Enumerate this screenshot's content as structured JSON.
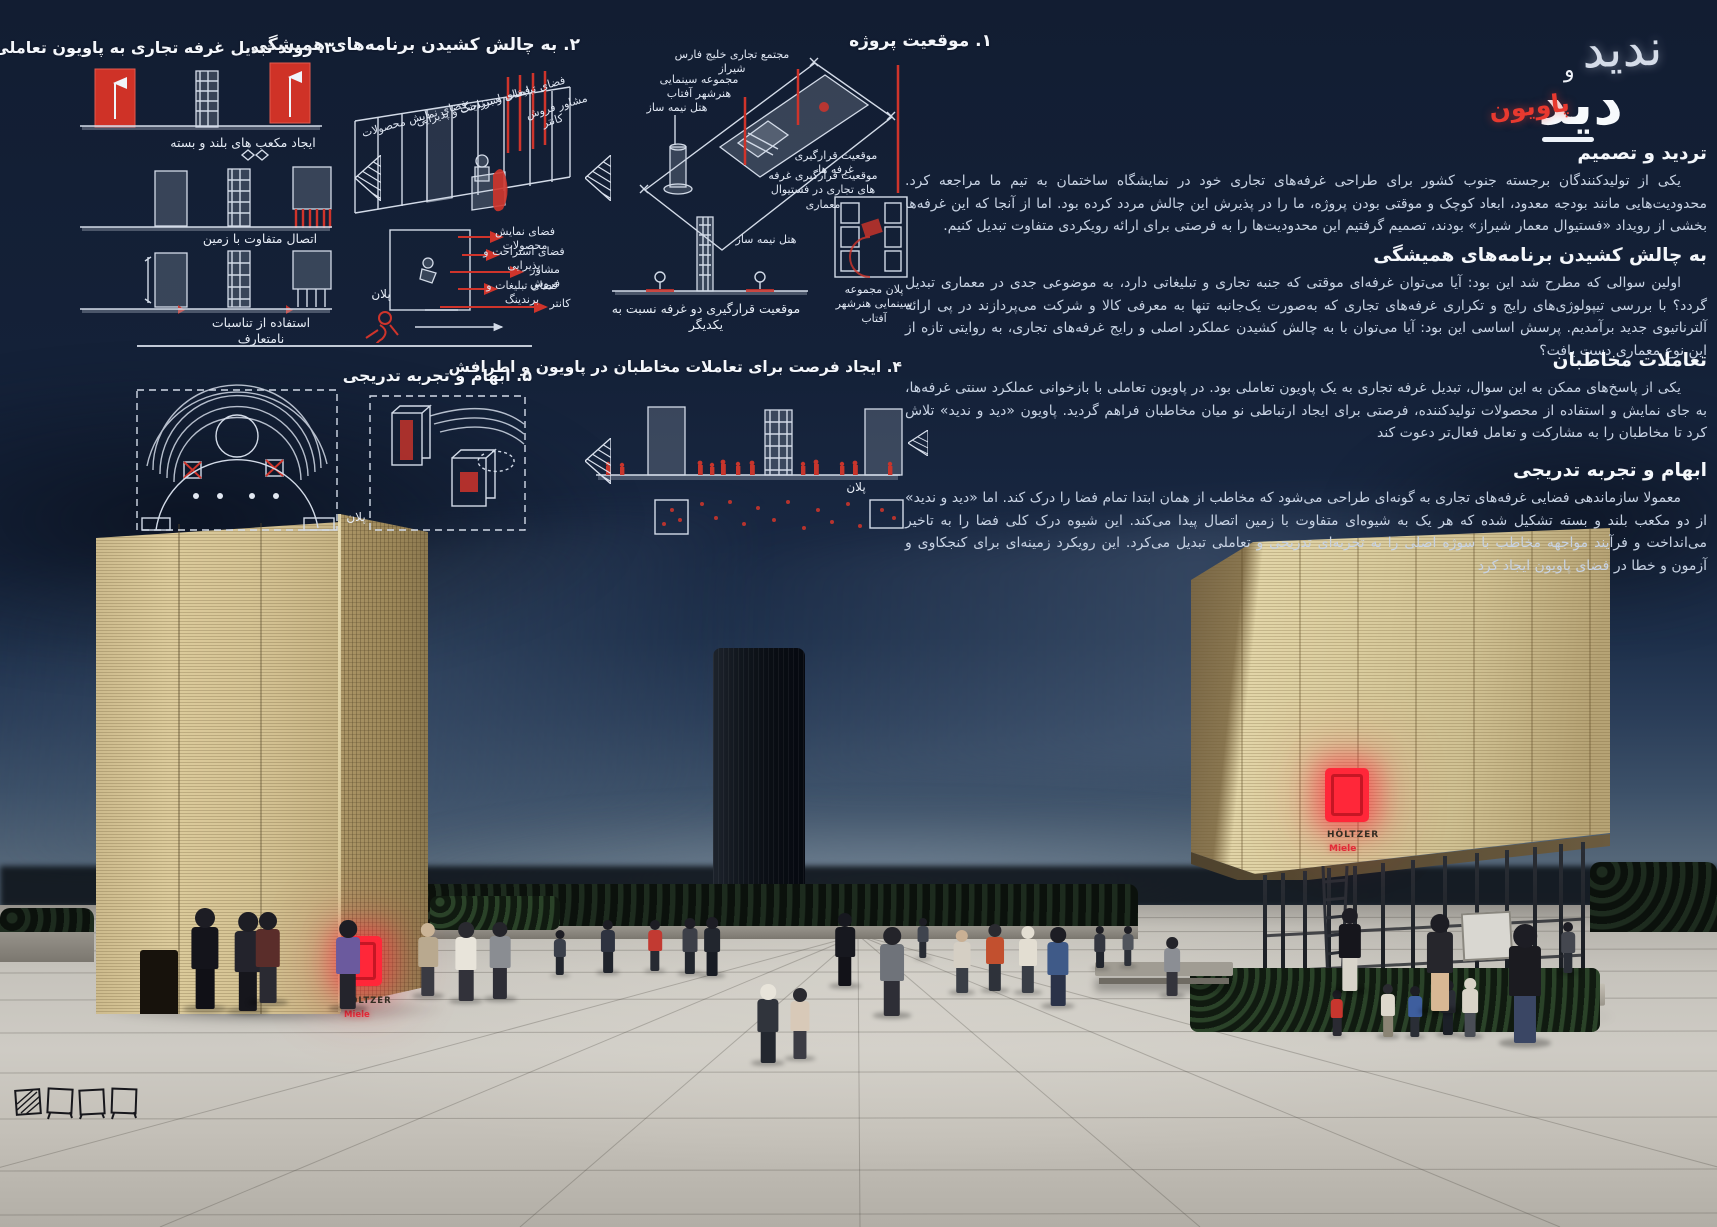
{
  "title": {
    "pavilion": "پاویون",
    "did": "دید",
    "va": "و",
    "nadid": "ندید"
  },
  "essay": {
    "sections": [
      {
        "heading": "تردید و تصمیم",
        "body": "یکی از تولیدکنندگان برجسته جنوب کشور برای طراحی غرفه‌های تجاری خود در نمایشگاه ساختمان به تیم ما مراجعه کرد. محدودیت‌هایی مانند بودجه معدود، ابعاد کوچک و موقتی بودن پروژه، ما را در پذیرش این چالش مردد کرده بود. اما از آنجا که این غرفه‌ها بخشی از رویداد «فستیوال معمار شیراز» بودند، تصمیم گرفتیم این محدودیت‌ها را به فرصتی برای ارائه رویکردی متفاوت تبدیل کنیم."
      },
      {
        "heading": "به چالش کشیدن برنامه‌های همیشگی",
        "body": "اولین سوالی که مطرح شد این بود: آیا می‌توان غرفه‌ای موقتی که جنبه تجاری و تبلیغاتی دارد، به موضوعی جدی در معماری تبدیل گردد؟ با بررسی تیپولوژی‌های رایج و تکراری غرفه‌های تجاری که به‌صورت یک‌جانبه تنها به معرفی کالا و شرکت می‌پردازند در پی ارائه آلترناتیوی جدید برآمدیم. پرسش اساسی این بود: آیا می‌توان با به چالش کشیدن عملکرد اصلی و رایج غرفه‌های تجاری، به روایتی تازه از این نوع معماری دست یافت؟"
      },
      {
        "heading": "تعاملات مخاطبان",
        "body": "یکی از پاسخ‌های ممکن به این سوال، تبدیل غرفه تجاری به یک پاویون تعاملی بود. در پاویون تعاملی با بازخوانی عملکرد سنتی غرفه‌ها، به جای نمایش و استفاده از محصولات تولیدکننده، فرصتی برای ایجاد ارتباطی نو میان مخاطبان فراهم گردید. پاویون «دید و ندید» تلاش کرد تا مخاطبان را به مشارکت و تعامل فعال‌تر دعوت کند"
      },
      {
        "heading": "ابهام و تجربه تدریجی",
        "body": "معمولا سازماندهی فضایی غرفه‌های تجاری به گونه‌ای طراحی می‌شود که مخاطب از همان ابتدا تمام فضا را درک کند. اما «دید و ندید» از دو مکعب بلند و بسته تشکیل شده که هر یک به شیوه‌ای متفاوت با زمین اتصال پیدا می‌کند. این شیوه درک کلی فضا را به تاخیر می‌انداخت و فرآیند مواجهه مخاطب با سوژه اصلی را به تجربه‌ای تدریجی و تعاملی تبدیل می‌کرد. این رویکرد زمینه‌ای برای کنجکاوی و آزمون و خطا در فضای پاویون ایجاد کرد"
      }
    ]
  },
  "diagrams": {
    "s1": {
      "heading": "۱. موقعیت پروژه",
      "labels": {
        "complex": "مجتمع تجاری خلیج فارس شیراز",
        "cinema": "مجموعه سینمایی هنرشهر آفتاب",
        "hotel": "هتل نیمه ساز",
        "booths_pos": "موقعیت قرارگیری غرفه ها",
        "booths_pos2": "موقعیت قرارگیری غرفه های تجاری در فستیوال معماری",
        "hotel2": "هتل نیمه ساز",
        "two_booths": "موقعیت قرارگیری دو غرفه نسبت به یکدیگر",
        "cinema_plan": "پلان مجموعه سینمایی هنرشهر آفتاب"
      }
    },
    "s2": {
      "heading": "۲. به چالش کشیدن برنامه‌های همیشگی",
      "labels": {
        "branding": "فضای تبلیغات و برندینگ",
        "rest": "فضای استراحت و پذیرایی",
        "display": "فضای نمایش محصولات",
        "consultant": "مشاور فروش",
        "counter": "کانتر",
        "plan": "پلان"
      }
    },
    "s3": {
      "heading": "۳. روند تبدیل غرفه تجاری به پاویون تعاملی",
      "captions": [
        "ایجاد مکعب های بلند و بسته",
        "اتصال متفاوت با زمین",
        "استفاده از تناسبات نامتعارف"
      ]
    },
    "s4": {
      "heading": "۴. ایجاد فرصت برای تعاملات مخاطبان در پاویون و اطرافش",
      "plan_label": "پلان"
    },
    "s5": {
      "heading": "۵. ابهام و تجربه تدریجی",
      "plan_label": "پلان"
    }
  },
  "photo": {
    "brand": "HÖLTZER",
    "brand_sub": "Miele"
  },
  "colors": {
    "accent_red": "#e8392f",
    "neon_red": "#ff2739",
    "board_bg": "#15223a",
    "straw": "#d8c79b"
  }
}
